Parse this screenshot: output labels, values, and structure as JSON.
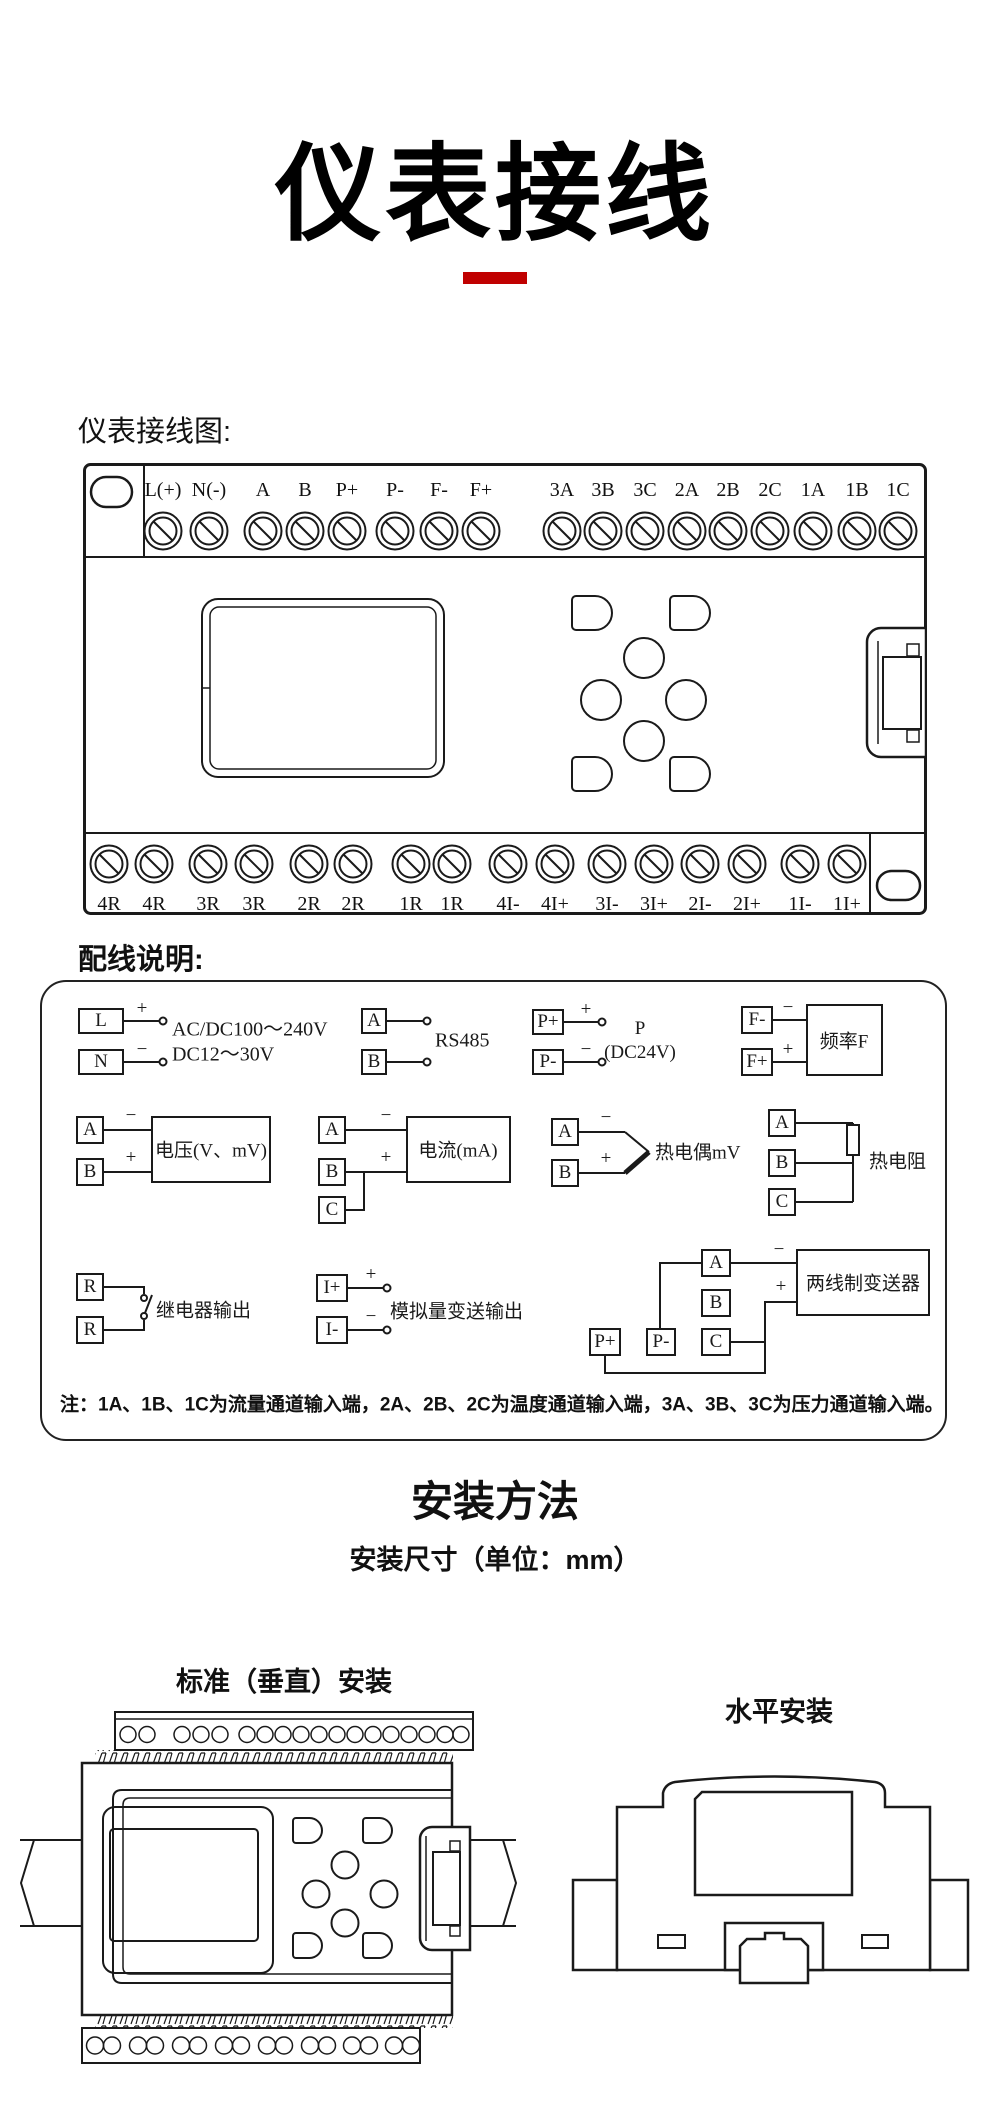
{
  "title": "仪表接线",
  "sections": {
    "wiring_label": "仪表接线图:",
    "panel_label": "配线说明:",
    "install_title": "安装方法",
    "install_subtitle": "安装尺寸（单位：mm）",
    "vertical_label": "标准（垂直）安装",
    "horizontal_label": "水平安装"
  },
  "colors": {
    "accent_red": "#c00000",
    "line": "#1a1a1a"
  },
  "terminals": {
    "top": [
      "L(+)",
      "N(-)",
      "A",
      "B",
      "P+",
      "P-",
      "F-",
      "F+",
      "3A",
      "3B",
      "3C",
      "2A",
      "2B",
      "2C",
      "1A",
      "1B",
      "1C"
    ],
    "bottom": [
      "4R",
      "4R",
      "3R",
      "3R",
      "2R",
      "2R",
      "1R",
      "1R",
      "4I-",
      "4I+",
      "3I-",
      "3I+",
      "2I-",
      "2I+",
      "1I-",
      "1I+"
    ]
  },
  "panel": {
    "power": {
      "t1": "L",
      "t2": "N",
      "plus": "+",
      "minus": "−",
      "line1": "AC/DC100～240V",
      "line2": "DC12～30V"
    },
    "rs485": {
      "t1": "A",
      "t2": "B",
      "label": "RS485"
    },
    "p24": {
      "t1": "P+",
      "t2": "P-",
      "plus": "+",
      "minus": "−",
      "line1": "P",
      "line2": "(DC24V)"
    },
    "freq": {
      "t1": "F-",
      "t2": "F+",
      "minus": "−",
      "plus": "+",
      "box": "频率F"
    },
    "volt": {
      "t1": "A",
      "t2": "B",
      "minus": "−",
      "plus": "+",
      "box": "电压(V、mV)"
    },
    "curr": {
      "t1": "A",
      "t2": "B",
      "t3": "C",
      "minus": "−",
      "plus": "+",
      "box": "电流(mA)"
    },
    "tc": {
      "t1": "A",
      "t2": "B",
      "minus": "−",
      "plus": "+",
      "label": "热电偶mV"
    },
    "rtd": {
      "t1": "A",
      "t2": "B",
      "t3": "C",
      "label": "热电阻"
    },
    "relay": {
      "t1": "R",
      "t2": "R",
      "label": "继电器输出"
    },
    "aout": {
      "t1": "I+",
      "t2": "I-",
      "plus": "+",
      "minus": "−",
      "label": "模拟量变送输出"
    },
    "tx": {
      "t1": "A",
      "t2": "B",
      "t3": "C",
      "t4": "P+",
      "t5": "P-",
      "minus": "−",
      "plus": "+",
      "box": "两线制变送器"
    },
    "note": "注：1A、1B、1C为流量通道输入端，2A、2B、2C为温度通道输入端，3A、3B、3C为压力通道输入端。"
  }
}
